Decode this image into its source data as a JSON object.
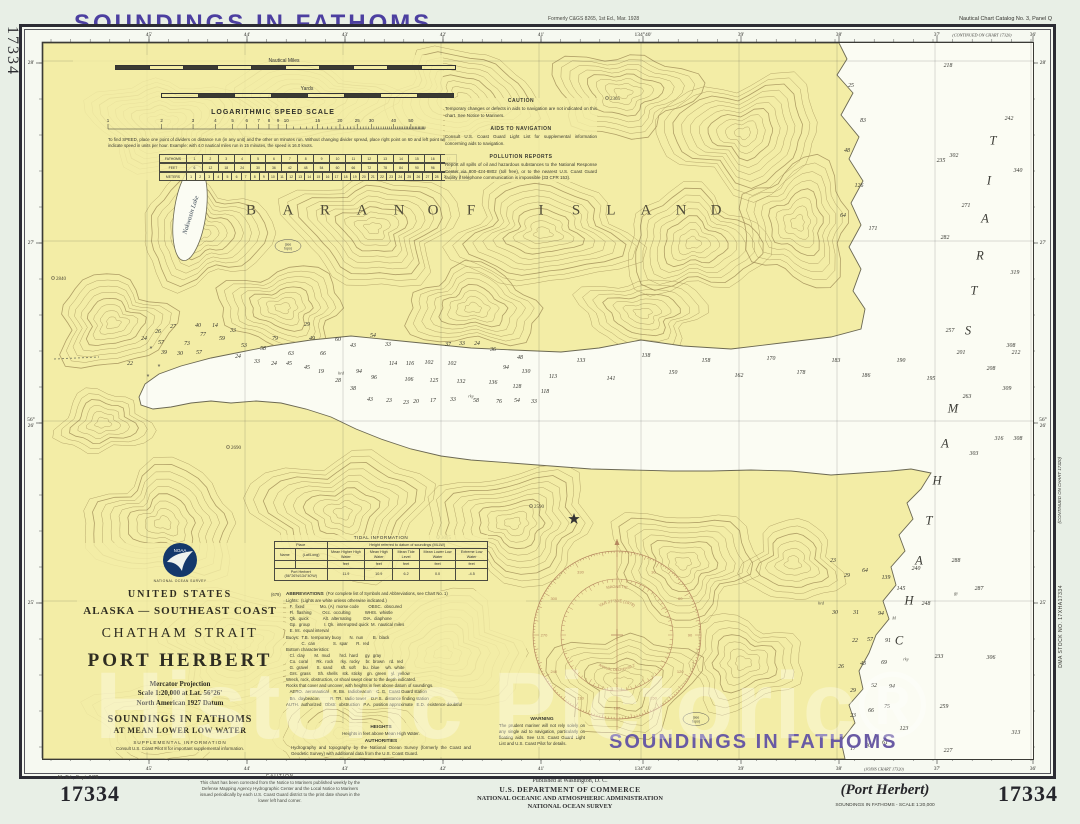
{
  "colors": {
    "purple": "#4c3fa0",
    "purple_light": "#695aa4",
    "land": "#f3eda6",
    "water": "#fbfcf3",
    "contour": "#a3905a",
    "coast": "#6b6852",
    "rose": "#b5875f",
    "frame": "#2c2c34",
    "page": "#e8efe6",
    "navy_logo": "#14386b"
  },
  "header": {
    "title": "SOUNDINGS IN FATHOMS",
    "formerly": "Formerly C&GS 8265, 1st Ed., Mar. 1928",
    "catalog": "Nautical Chart Catalog No. 3, Panel Q",
    "side_number": "17334"
  },
  "margins": {
    "top_labels": [
      {
        "t": "45'",
        "x": 146
      },
      {
        "t": "44'",
        "x": 244
      },
      {
        "t": "43'",
        "x": 342
      },
      {
        "t": "42'",
        "x": 440
      },
      {
        "t": "41'",
        "x": 538
      },
      {
        "t": "134°40'",
        "x": 640
      },
      {
        "t": "39'",
        "x": 738
      },
      {
        "t": "38'",
        "x": 836
      },
      {
        "t": "37'",
        "x": 934
      },
      {
        "t": "36'",
        "x": 1030
      }
    ],
    "bottom_labels": [
      {
        "t": "45'",
        "x": 146
      },
      {
        "t": "44'",
        "x": 244
      },
      {
        "t": "43'",
        "x": 342
      },
      {
        "t": "42'",
        "x": 440
      },
      {
        "t": "41'",
        "x": 538
      },
      {
        "t": "134°40'",
        "x": 640
      },
      {
        "t": "39'",
        "x": 738
      },
      {
        "t": "38'",
        "x": 836
      },
      {
        "t": "37'",
        "x": 934
      },
      {
        "t": "36'",
        "x": 1030
      }
    ],
    "side_labels": [
      {
        "t": "28'",
        "y": 60
      },
      {
        "t": "27'",
        "y": 240
      },
      {
        "t": "56°26'",
        "y": 420
      },
      {
        "t": "25'",
        "y": 600
      }
    ],
    "continued_top": "(CONTINUED ON CHART 17320)",
    "continued_right": "(CONTINUED ON CHART 17320)",
    "joins_bottom": "(JOINS CHART 17320)",
    "dma": "DMA STOCK NO. 17XHA17334"
  },
  "scales": {
    "nm_label": "Nautical Miles",
    "yards_label": "Yards",
    "log_title": "LOGARITHMIC SPEED SCALE",
    "log_values": [
      1,
      2,
      3,
      4,
      5,
      6,
      7,
      8,
      9,
      10,
      15,
      20,
      25,
      30,
      40,
      50
    ],
    "log_note": "To find SPEED, place one point of dividers on distance run (in any unit) and the other on minutes run. Without changing divider spread, place right point on 60 and left point will then indicate speed in units per hour. Example: with 4.0 nautical miles run in 15 minutes, the speed is 16.0 knots.",
    "conv_rows": [
      {
        "label": "FATHOMS",
        "cells": [
          "1",
          "2",
          "3",
          "4",
          "5",
          "6",
          "7",
          "8",
          "9",
          "10",
          "11",
          "12",
          "13",
          "14",
          "15",
          "16",
          "17"
        ]
      },
      {
        "label": "FEET",
        "cells": [
          "6",
          "12",
          "18",
          "24",
          "30",
          "36",
          "42",
          "48",
          "54",
          "60",
          "66",
          "72",
          "78",
          "84",
          "90",
          "96",
          "102"
        ]
      },
      {
        "label": "METERS",
        "cells": [
          "1",
          "2",
          "3",
          "4",
          "5",
          "6",
          "7",
          "8",
          "9",
          "10",
          "11",
          "12",
          "13",
          "14",
          "15",
          "16",
          "17",
          "18",
          "19",
          "20",
          "21",
          "22",
          "23",
          "24",
          "25",
          "26",
          "27",
          "28",
          "29",
          "30",
          "31"
        ]
      }
    ]
  },
  "notes": {
    "caution_title": "CAUTION",
    "caution_body": "Temporary changes or defects in aids to navigation are not indicated on this chart. See Notice to Mariners.",
    "aids_title": "AIDS TO NAVIGATION",
    "aids_body": "Consult U.S. Coast Guard Light List for supplemental information concerning aids to navigation.",
    "pollution_title": "POLLUTION REPORTS",
    "pollution_body": "Report all spills of oil and hazardous substances to the National Response Center via 800-424-8802 (toll free), or to the nearest U.S. Coast Guard facility if telephone communication is impossible (33 CFR 153).",
    "warning_title": "WARNING",
    "warning_body": "The prudent mariner will not rely solely on any single aid to navigation, particularly on floating aids. See U.S. Coast Guard Light List and U.S. Coast Pilot for details."
  },
  "title_block": {
    "country": "UNITED STATES",
    "region": "ALASKA — SOUTHEAST COAST",
    "strait": "CHATHAM STRAIT",
    "name": "PORT HERBERT",
    "projection": "Mercator Projection",
    "scale": "Scale 1:20,000 at Lat. 56°26'",
    "datum": "North American 1927 Datum",
    "soundings1": "SOUNDINGS IN FATHOMS",
    "soundings2": "AT MEAN LOWER LOW WATER",
    "supp_title": "SUPPLEMENTAL INFORMATION",
    "supp_body": "Consult U.S. Coast Pilot 8 for important supplemental information.",
    "agency_small": "NATIONAL OCEAN SURVEY",
    "logo_text": "NOAA"
  },
  "tidal": {
    "caption": "TIDAL INFORMATION",
    "place_header": "Place",
    "height_header": "Height referred to datum of soundings (MLLW)",
    "col1": "Name",
    "col2": "(Lat/Long)",
    "cols": [
      "Mean Higher High Water",
      "Mean High Water",
      "Mean Tide Level",
      "Mean Lower Low Water",
      "Extreme Low Water"
    ],
    "unit": "feet",
    "row_name": "Port Herbert (56°26'N/134°40'W)",
    "row_values": [
      "11.9",
      "10.9",
      "6.2",
      "0.0",
      "-4.5"
    ],
    "footnote": "(679)"
  },
  "abbreviations": {
    "title": "ABBREVIATIONS",
    "title_note": "(For complete list of Symbols and Abbreviations, see Chart No. 1)",
    "lines": [
      "Lights:  (Lights are white unless otherwise indicated.)",
      "   F.  fixed             Mo. (A)  morse code        OBSC.  obscured",
      "   Fl.  flashing         Occ.  occulting            WHIS.  whistle",
      "   Qk.  quick            Alt.  alternating          DIA.  diaphone",
      "   Gp.  group            I. Qk.  interrupted quick  M.  nautical miles",
      "   E. Int.  equal interval",
      "Buoys:  T.B.  temporary buoy       N.  nun        B.  black",
      "             C.  can               S.  spar       R.  red",
      "Bottom characteristics:",
      "   Cl.  clay        M.  mud        hrd.  hard      gy.  gray",
      "   Co.  coral       Rk.  rock      rky.  rocky     br.  brown    rd.  red",
      "   G.  gravel       S.  sand       sft.  soft      bu.  blue     wh.  white",
      "   Grs.  grass      Sh.  shells    stk.  sticky    gn.  green    yl.  yellow",
      "Wreck, rock, obstruction, or shoal swept clear to the depth indicated.",
      "Rocks that cover and uncover, with heights in feet above datum of soundings.",
      "   AERO.  aeronautical    R. Bn.  radiobeacon    C. G.  Coast Guard station",
      "   Bn.  daybeacon         R. TR.  radio tower    D.F.S.  distance finding station",
      "AUTH.  authorized   Obstr.  obstruction   P.A.  position approximate   E.D.  existence doubtful"
    ]
  },
  "heights": {
    "title": "HEIGHTS",
    "body": "Heights in feet above Mean High Water.",
    "auth_title": "AUTHORITIES",
    "auth_body": "Hydrography and topography by the National Ocean Survey (formerly the Coast and Geodetic Survey) with additional data from the U.S. Coast Guard."
  },
  "map_labels": {
    "island_word1": [
      [
        "B",
        208
      ],
      [
        "A",
        245
      ],
      [
        "R",
        282
      ],
      [
        "A",
        319
      ],
      [
        "N",
        356
      ],
      [
        "O",
        390
      ],
      [
        "F",
        428
      ]
    ],
    "island_word2": [
      [
        "I",
        498
      ],
      [
        "S",
        533
      ],
      [
        "L",
        568
      ],
      [
        "A",
        603
      ],
      [
        "N",
        638
      ],
      [
        "D",
        673
      ]
    ],
    "island_y": 168,
    "strait_word1": [
      [
        "C",
        856,
        598
      ],
      [
        "H",
        866,
        558
      ],
      [
        "A",
        876,
        518
      ],
      [
        "T",
        886,
        478
      ],
      [
        "H",
        894,
        438
      ],
      [
        "A",
        902,
        401
      ],
      [
        "M",
        910,
        366
      ]
    ],
    "strait_word2": [
      [
        "S",
        925,
        288
      ],
      [
        "T",
        931,
        248
      ],
      [
        "R",
        937,
        213
      ],
      [
        "A",
        942,
        176
      ],
      [
        "I",
        946,
        138
      ],
      [
        "T",
        950,
        98
      ]
    ],
    "lake": "Nakwasin Lake",
    "soundings_note": "SOUNDINGS IN FATHOMS",
    "peaks": [
      [
        2840,
        10,
        235
      ],
      [
        2690,
        185,
        404
      ],
      [
        3075,
        395,
        494
      ],
      [
        2590,
        488,
        463
      ],
      [
        2365,
        564,
        55
      ]
    ],
    "see_topo_line1": "(see",
    "see_topo_line2": "topo)",
    "see_topo_pos": [
      [
        245,
        203
      ],
      [
        653,
        676
      ]
    ],
    "rocks": [
      [
        108,
        308
      ],
      [
        116,
        326
      ],
      [
        105,
        336
      ]
    ]
  },
  "compass": {
    "var_line": "VAR 27°30'E (1978)",
    "magnetic": "MAGNETIC",
    "annual": "ANNUAL DECREASE 2'",
    "degree_labels": [
      30,
      60,
      90,
      120,
      150,
      180,
      210,
      240,
      270,
      300,
      330
    ]
  },
  "soundings": [
    [
      22,
      129,
      363
    ],
    [
      24,
      143,
      338
    ],
    [
      26,
      157,
      331
    ],
    [
      57,
      160,
      342
    ],
    [
      27,
      172,
      326
    ],
    [
      40,
      197,
      325
    ],
    [
      77,
      202,
      334
    ],
    [
      73,
      186,
      343
    ],
    [
      39,
      163,
      352
    ],
    [
      30,
      179,
      353
    ],
    [
      57,
      198,
      352
    ],
    [
      14,
      214,
      325
    ],
    [
      59,
      221,
      338
    ],
    [
      33,
      232,
      330
    ],
    [
      53,
      243,
      345
    ],
    [
      24,
      237,
      356
    ],
    [
      58,
      262,
      348
    ],
    [
      33,
      256,
      361
    ],
    [
      24,
      273,
      363
    ],
    [
      79,
      274,
      338
    ],
    [
      45,
      288,
      363
    ],
    [
      63,
      290,
      353
    ],
    [
      29,
      306,
      324
    ],
    [
      49,
      311,
      338
    ],
    [
      66,
      322,
      353
    ],
    [
      45,
      306,
      367
    ],
    [
      19,
      320,
      371
    ],
    [
      60,
      337,
      339
    ],
    [
      28,
      337,
      380
    ],
    [
      38,
      352,
      388
    ],
    [
      43,
      352,
      345
    ],
    [
      94,
      358,
      371
    ],
    [
      96,
      373,
      377
    ],
    [
      54,
      372,
      335
    ],
    [
      33,
      387,
      344
    ],
    [
      114,
      392,
      363
    ],
    [
      116,
      409,
      363
    ],
    [
      102,
      428,
      362
    ],
    [
      106,
      408,
      379
    ],
    [
      125,
      433,
      380
    ],
    [
      102,
      451,
      363
    ],
    [
      132,
      460,
      381
    ],
    [
      136,
      492,
      382
    ],
    [
      37,
      447,
      344
    ],
    [
      33,
      461,
      343
    ],
    [
      24,
      476,
      343
    ],
    [
      36,
      492,
      349
    ],
    [
      94,
      505,
      367
    ],
    [
      130,
      525,
      371
    ],
    [
      128,
      516,
      386
    ],
    [
      113,
      552,
      376
    ],
    [
      118,
      544,
      391
    ],
    [
      48,
      519,
      357
    ],
    [
      43,
      369,
      399
    ],
    [
      23,
      388,
      400
    ],
    [
      23,
      405,
      402
    ],
    [
      20,
      415,
      401
    ],
    [
      17,
      432,
      400
    ],
    [
      33,
      452,
      399
    ],
    [
      58,
      475,
      400
    ],
    [
      76,
      498,
      401
    ],
    [
      54,
      516,
      400
    ],
    [
      33,
      533,
      401
    ],
    [
      133,
      580,
      360
    ],
    [
      141,
      610,
      378
    ],
    [
      138,
      645,
      355
    ],
    [
      150,
      672,
      372
    ],
    [
      158,
      705,
      360
    ],
    [
      162,
      738,
      375
    ],
    [
      170,
      770,
      358
    ],
    [
      178,
      800,
      372
    ],
    [
      183,
      835,
      360
    ],
    [
      186,
      865,
      375
    ],
    [
      190,
      900,
      360
    ],
    [
      195,
      930,
      378
    ],
    [
      201,
      960,
      352
    ],
    [
      208,
      990,
      368
    ],
    [
      212,
      1015,
      352
    ],
    [
      218,
      947,
      65
    ],
    [
      242,
      1008,
      118
    ],
    [
      302,
      953,
      155
    ],
    [
      340,
      1017,
      170
    ],
    [
      235,
      940,
      160
    ],
    [
      282,
      944,
      237
    ],
    [
      319,
      1014,
      272
    ],
    [
      271,
      965,
      205
    ],
    [
      257,
      949,
      330
    ],
    [
      308,
      1010,
      345
    ],
    [
      309,
      1006,
      388
    ],
    [
      263,
      966,
      396
    ],
    [
      316,
      998,
      438
    ],
    [
      308,
      1017,
      438
    ],
    [
      303,
      973,
      453
    ],
    [
      25,
      850,
      85
    ],
    [
      83,
      862,
      120
    ],
    [
      48,
      846,
      150
    ],
    [
      126,
      858,
      185
    ],
    [
      64,
      842,
      215
    ],
    [
      171,
      872,
      228
    ],
    [
      23,
      832,
      560
    ],
    [
      29,
      846,
      575
    ],
    [
      64,
      864,
      570
    ],
    [
      139,
      885,
      577
    ],
    [
      240,
      915,
      568
    ],
    [
      288,
      955,
      560
    ],
    [
      145,
      900,
      588
    ],
    [
      287,
      978,
      588
    ],
    [
      248,
      925,
      603
    ],
    [
      30,
      834,
      612
    ],
    [
      31,
      855,
      612
    ],
    [
      94,
      880,
      613
    ],
    [
      22,
      854,
      640
    ],
    [
      57,
      869,
      639
    ],
    [
      91,
      887,
      640
    ],
    [
      233,
      938,
      656
    ],
    [
      306,
      990,
      657
    ],
    [
      26,
      840,
      666
    ],
    [
      43,
      862,
      663
    ],
    [
      69,
      883,
      662
    ],
    [
      52,
      873,
      685
    ],
    [
      94,
      891,
      686
    ],
    [
      29,
      852,
      690
    ],
    [
      23,
      852,
      715
    ],
    [
      66,
      870,
      710
    ],
    [
      75,
      886,
      706
    ],
    [
      259,
      943,
      706
    ],
    [
      123,
      903,
      728
    ],
    [
      313,
      1015,
      732
    ],
    [
      40,
      867,
      745
    ],
    [
      61,
      884,
      742
    ],
    [
      227,
      947,
      750
    ],
    [
      17,
      852,
      748
    ]
  ],
  "bottom_types": [
    [
      "hrd",
      340,
      372
    ],
    [
      "rky",
      470,
      395
    ],
    [
      "rky",
      905,
      658
    ],
    [
      "gy",
      955,
      592
    ],
    [
      "hrd",
      820,
      602
    ],
    [
      "M",
      893,
      617
    ]
  ],
  "footer": {
    "edition": "4th Ed., Sept. 3/78",
    "number_left": "17334",
    "number_right": "17334",
    "caution_title": "CAUTION",
    "caution_body": "This chart has been corrected from the Notice to Mariners published weekly by the Defense Mapping Agency Hydrographic Center and the Local Notice to Mariners issued periodically by each U.S. Coast Guard district to the print date shown in the lower left hand corner.",
    "pub1": "Published at Washington, D. C.",
    "pub2": "U.S. DEPARTMENT OF COMMERCE",
    "pub3": "NATIONAL OCEANIC AND ATMOSPHERIC ADMINISTRATION",
    "pub4": "NATIONAL OCEAN SURVEY",
    "port": "(Port Herbert)",
    "scale_line": "SOUNDINGS IN FATHOMS - SCALE 1:20,000"
  },
  "watermark": {
    "text": "Historic Pictoric",
    "mark": "®"
  }
}
